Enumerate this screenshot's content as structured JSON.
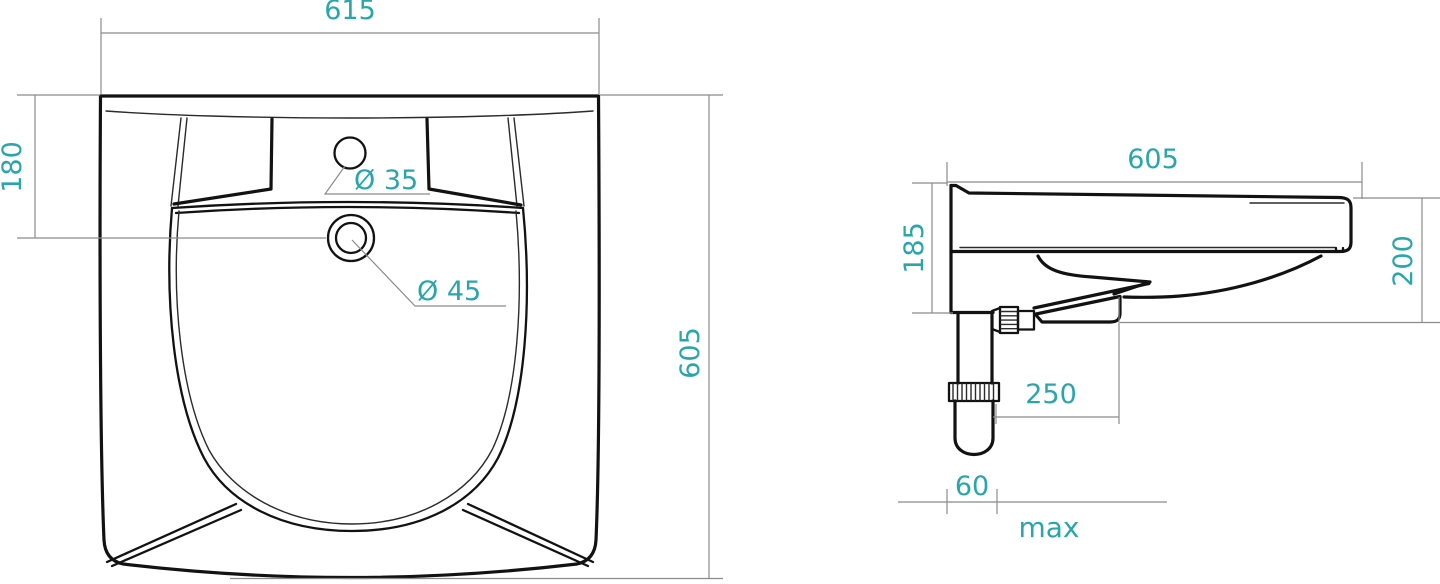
{
  "colors": {
    "accent_dimension_text": "#29A6AC",
    "drawing_line": "#121212",
    "dimension_line": "#8B8B8B",
    "background": "#FFFFFF"
  },
  "views": {
    "top": {
      "dim_overall_width": "615",
      "dim_faucet_hole_offset": "180",
      "dim_overall_depth": "605",
      "dim_faucet_hole_diameter": "Ø 35",
      "dim_drain_hole_diameter": "Ø 45"
    },
    "side": {
      "dim_overall_depth": "605",
      "dim_back_height": "185",
      "dim_front_height": "200",
      "dim_trap_offset": "250",
      "dim_pipe_width": "60",
      "dim_qualifier": "max"
    }
  }
}
